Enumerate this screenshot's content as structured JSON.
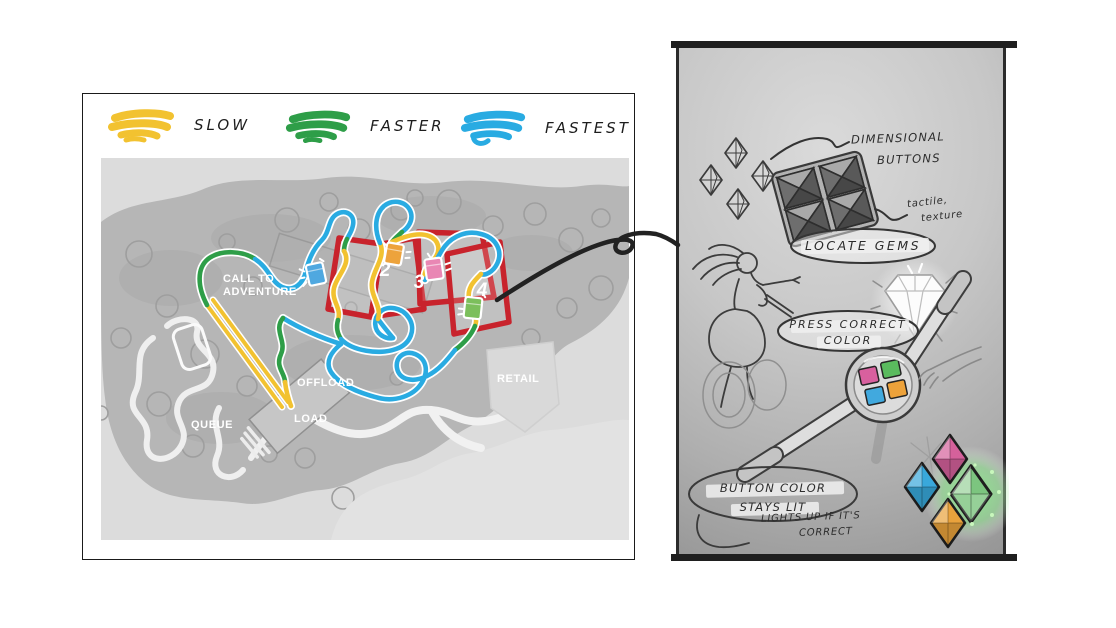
{
  "legend": {
    "items": [
      {
        "label": "SLOW",
        "color": "#F2C230"
      },
      {
        "label": "FASTER",
        "color": "#2E9E48"
      },
      {
        "label": "FASTEST",
        "color": "#29ABE2"
      }
    ]
  },
  "map": {
    "track_colors": {
      "slow": "#F2C230",
      "faster": "#2E9E48",
      "fastest": "#29ABE2"
    },
    "zone_color": "#C8232C",
    "labels": {
      "call_to_adventure": "CALL TO ADVENTURE",
      "offload": "OFFLOAD",
      "load": "LOAD",
      "queue": "QUEUE",
      "retail": "RETAIL"
    },
    "markers": [
      {
        "id": "gem-1",
        "number": "",
        "color": "#4FA8E0"
      },
      {
        "id": "gem-2",
        "number": "2",
        "color": "#EDA33C"
      },
      {
        "id": "gem-3",
        "number": "3",
        "color": "#E987B4"
      },
      {
        "id": "gem-4",
        "number": "4",
        "color": "#7CBF5C"
      }
    ]
  },
  "sketch": {
    "annotations": {
      "dimensional_line1": "DIMENSIONAL",
      "dimensional_line2": "BUTTONS",
      "tactile_line1": "tactile,",
      "tactile_line2": "texture",
      "locate_gems": "LOCATE GEMS",
      "press_line1": "PRESS CORRECT",
      "press_line2": "COLOR",
      "button_color_line1": "BUTTON COLOR",
      "button_color_line2": "STAYS LIT",
      "lights_line1": "LIGHTS UP IF IT'S",
      "lights_line2": "CORRECT"
    },
    "gem_colors": {
      "pink": "#D5619B",
      "blue": "#39A8DB",
      "green": "#7CC57F",
      "glow": "#8FE88F",
      "orange": "#E9A23C"
    },
    "button_colors": {
      "pink": "#D8609E",
      "green": "#5ABB5E",
      "blue": "#41A9DE",
      "orange": "#EDA23A"
    }
  }
}
